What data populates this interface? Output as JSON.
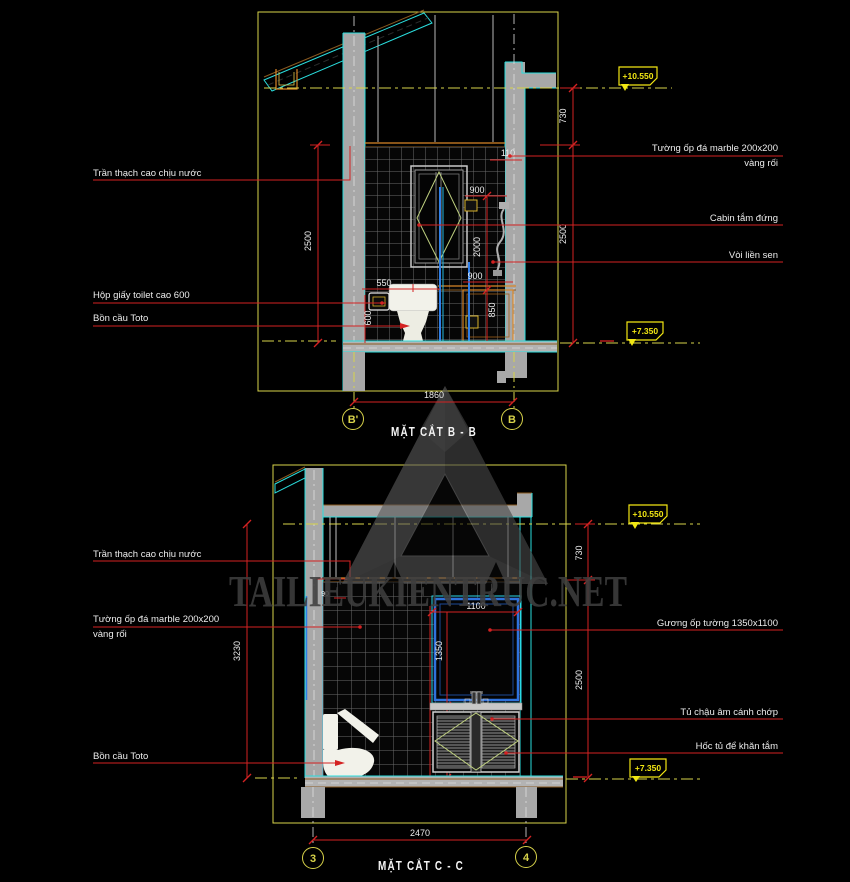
{
  "watermark": {
    "site_text": "TAILIEUKIENTRUC.NET"
  },
  "colors": {
    "background": "#000000",
    "cad_red": "#d42222",
    "cad_yellow": "#d8d34a",
    "bright_yellow": "#f2e713",
    "cyan": "#2adede",
    "orange": "#d98627",
    "pipe_blue": "#2f7fe8",
    "door_swing_green": "#becf7f",
    "concrete_gray": "#a8a8a8"
  },
  "section_b": {
    "title": "MẶT CẮT B - B",
    "bubble_left": "B'",
    "bubble_right": "B",
    "level_top": "+10.550",
    "level_floor": "+7.350",
    "label_ceiling": "Trần thạch cao chịu nước",
    "label_paper_box": "Hộp giấy toilet cao 600",
    "label_toilet": "Bồn cầu Toto",
    "label_wall_line1": "Tường ốp đá marble 200x200",
    "label_wall_line2": "vàng rối",
    "label_cabin": "Cabin tắm đứng",
    "label_shower": "Vòi liền sen",
    "dim_total_width": "1860",
    "dim_top": "730",
    "dim_right_height": "2500",
    "dim_left_height": "2500",
    "dim_ledge": "110",
    "dim_cabin_width": "900",
    "dim_cabin_height": "2000",
    "dim_toilet_offset": "550",
    "dim_paper_height": "600",
    "dim_bench_width": "900",
    "dim_bench_height": "850"
  },
  "section_c": {
    "title": "MẶT CẮT C - C",
    "bubble_left": "3",
    "bubble_right": "4",
    "level_top": "+10.550",
    "level_floor": "+7.350",
    "label_ceiling": "Trần thạch cao chịu nước",
    "label_wall_line1": "Tường ốp đá marble 200x200",
    "label_wall_line2": "vàng rối",
    "label_toilet": "Bồn cầu Toto",
    "label_mirror": "Gương  ốp tường  1350x1100",
    "label_cabinet": "Tủ chậu âm cánh chớp",
    "label_niche": "Hốc tủ để khăn tắm",
    "dim_total_width": "2470",
    "dim_top": "730",
    "dim_right_height": "2500",
    "dim_left_height": "3230",
    "dim_mirror_width": "1100",
    "dim_mirror_height": "1350",
    "dim_cabinet_height": "950",
    "dim_tile_offset": "90"
  }
}
